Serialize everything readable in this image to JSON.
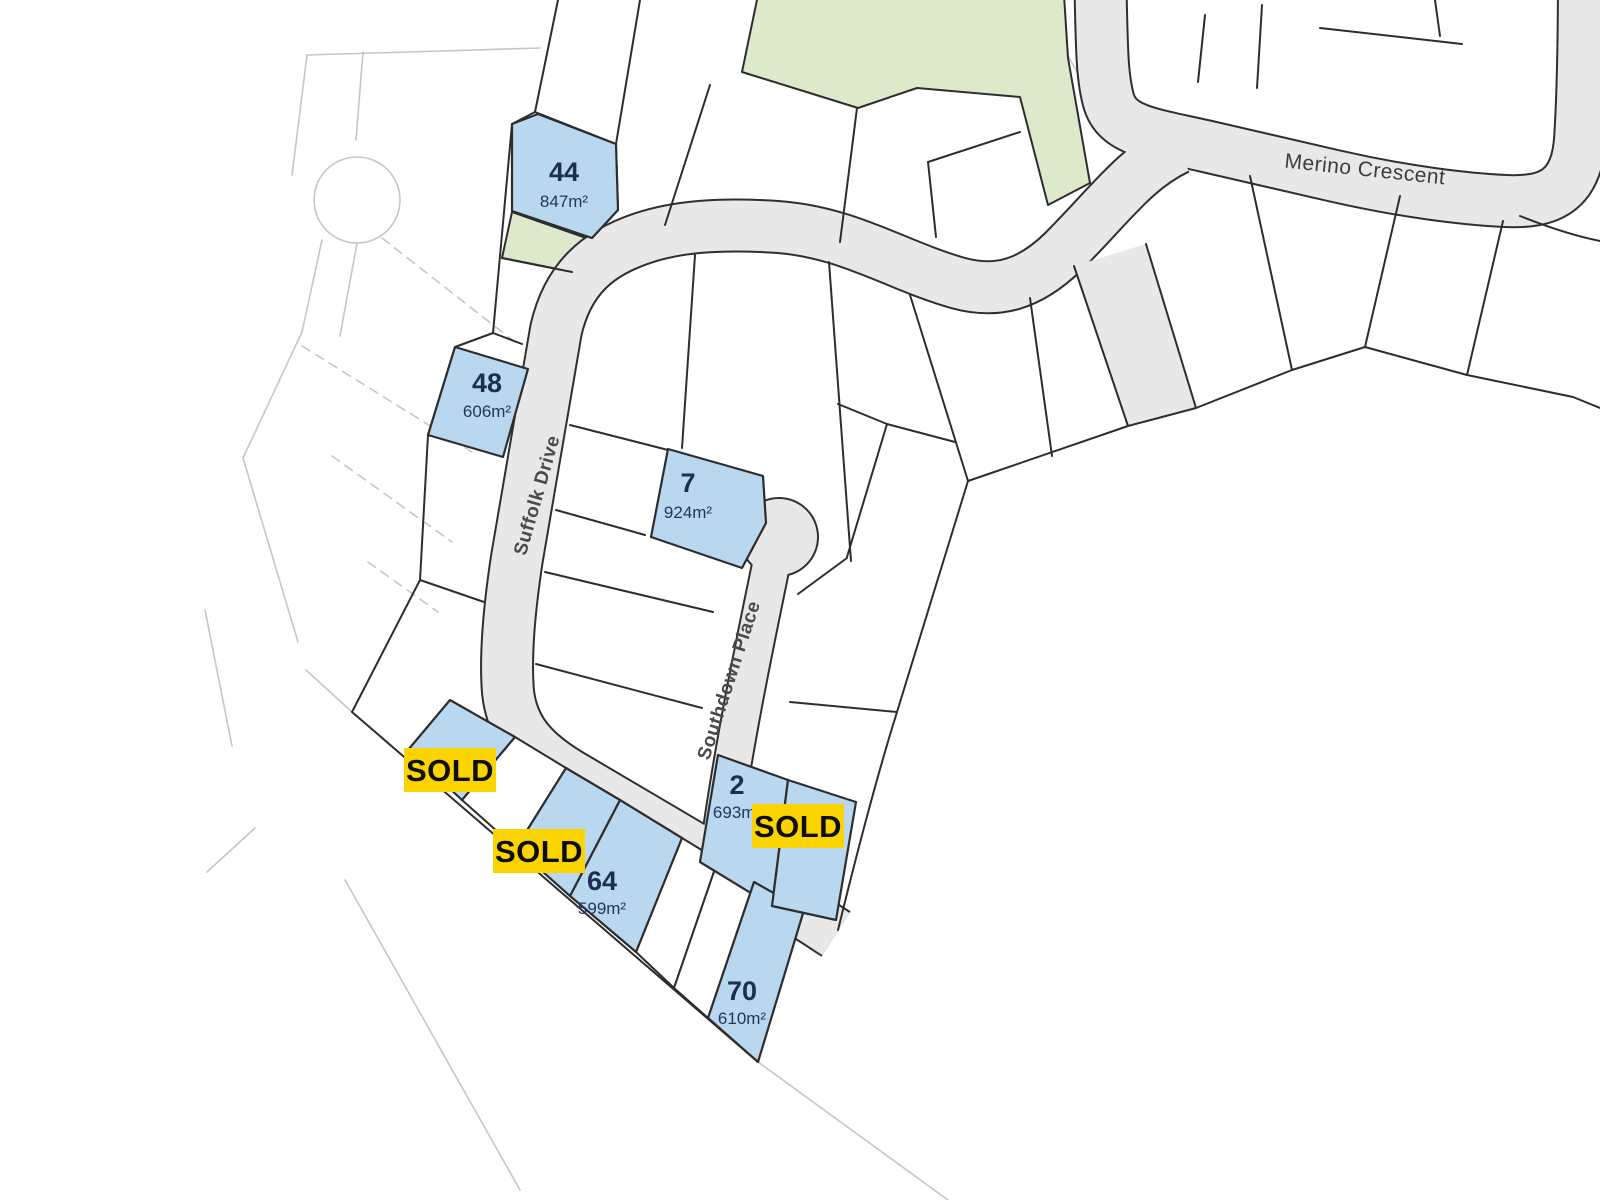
{
  "streets": {
    "merino": "Merino Crescent",
    "suffolk": "Suffolk Drive",
    "southdown": "Southdown Place"
  },
  "lots": [
    {
      "id": "44",
      "area": "847m²",
      "status": "available"
    },
    {
      "id": "48",
      "area": "606m²",
      "status": "available"
    },
    {
      "id": "7",
      "area": "924m²",
      "status": "available"
    },
    {
      "id": "2",
      "area": "693m²",
      "status": "available"
    },
    {
      "id": "64",
      "area": "599m²",
      "status": "available"
    },
    {
      "id": "70",
      "area": "610m²",
      "status": "available"
    }
  ],
  "sold_badges": [
    {
      "label": "SOLD"
    },
    {
      "label": "SOLD"
    },
    {
      "label": "SOLD"
    }
  ],
  "colors": {
    "available_lot_fill": "#b9d7ef",
    "sold_badge": "#fbd400",
    "park_green": "#dde9cb",
    "road_gray": "#e8e8e8",
    "lot_line": "#2d2d2d",
    "lot_text": "#1c2e52",
    "street_text": "#4a4a4a"
  }
}
